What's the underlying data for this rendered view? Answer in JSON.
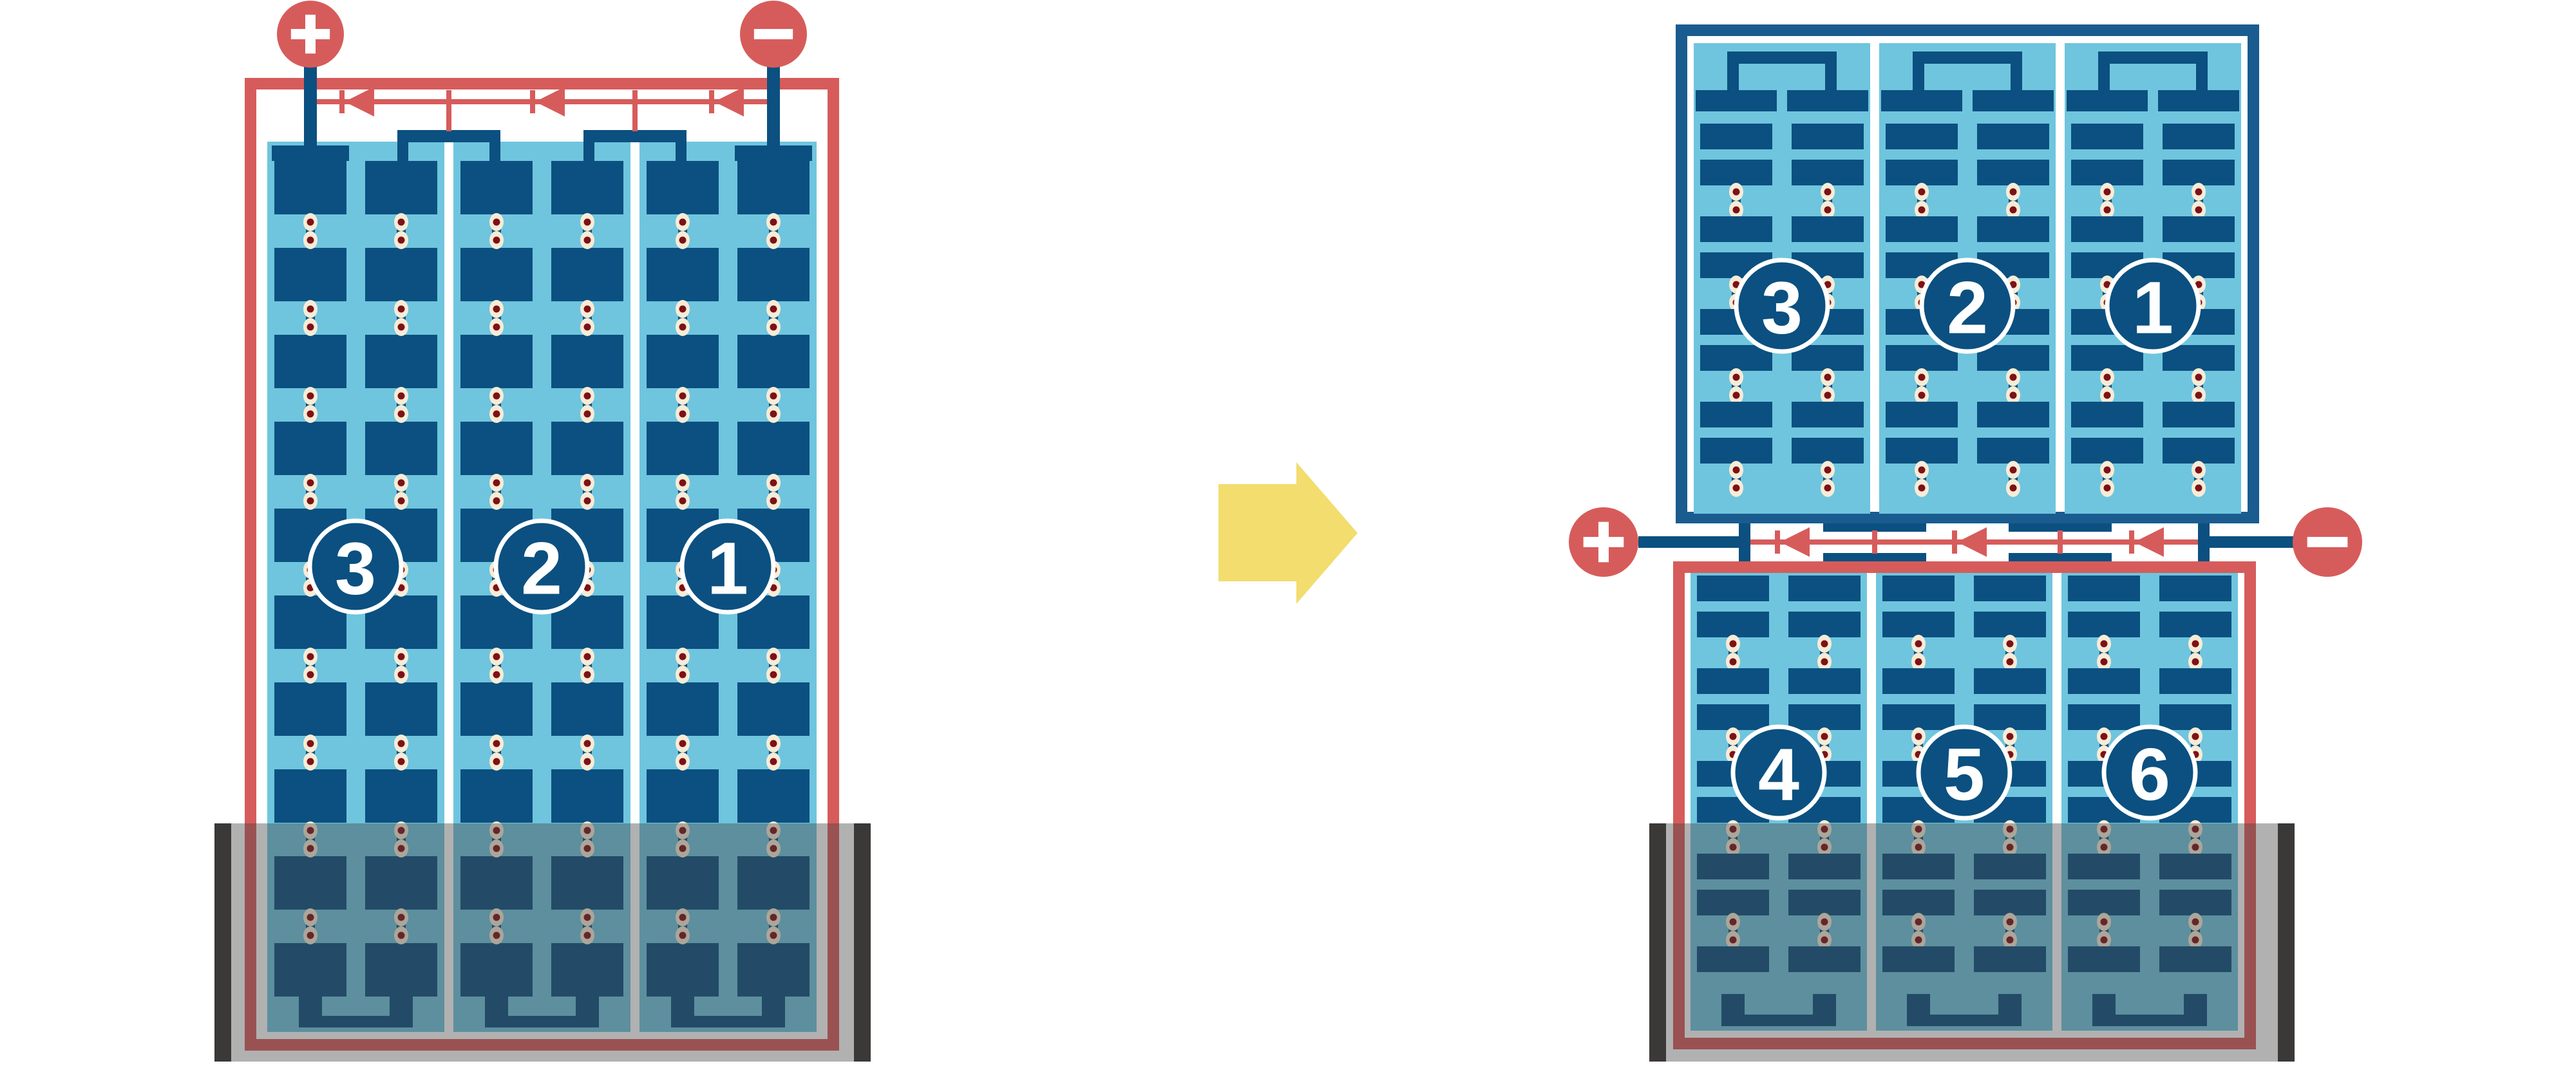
{
  "palette": {
    "red": "#D65C5B",
    "dark_blue": "#0B5080",
    "frame_blue": "#1A5C90",
    "light_blue": "#6FC5DE",
    "cream": "#F7ECD7",
    "maroon": "#7E1115",
    "white": "#FFFFFF",
    "yellow": "#F2DD6E",
    "shade": "rgba(70,70,70,0.42)",
    "shade_cap": "#3B3938",
    "circle_fill": "#0B5080"
  },
  "left_module": {
    "terminals": [
      {
        "label": "+"
      },
      {
        "label": "−"
      }
    ],
    "string_labels": [
      "3",
      "2",
      "1"
    ],
    "columns": 3,
    "diode_count": 3,
    "shaded_bottom": true
  },
  "arrow": {
    "direction": "right"
  },
  "right_assembly": {
    "terminals": [
      {
        "label": "+"
      },
      {
        "label": "−"
      }
    ],
    "diode_count": 3,
    "top_module": {
      "string_labels": [
        "3",
        "2",
        "1"
      ],
      "columns": 3
    },
    "bottom_module": {
      "string_labels": [
        "4",
        "5",
        "6"
      ],
      "columns": 3,
      "shaded_bottom": true
    }
  }
}
